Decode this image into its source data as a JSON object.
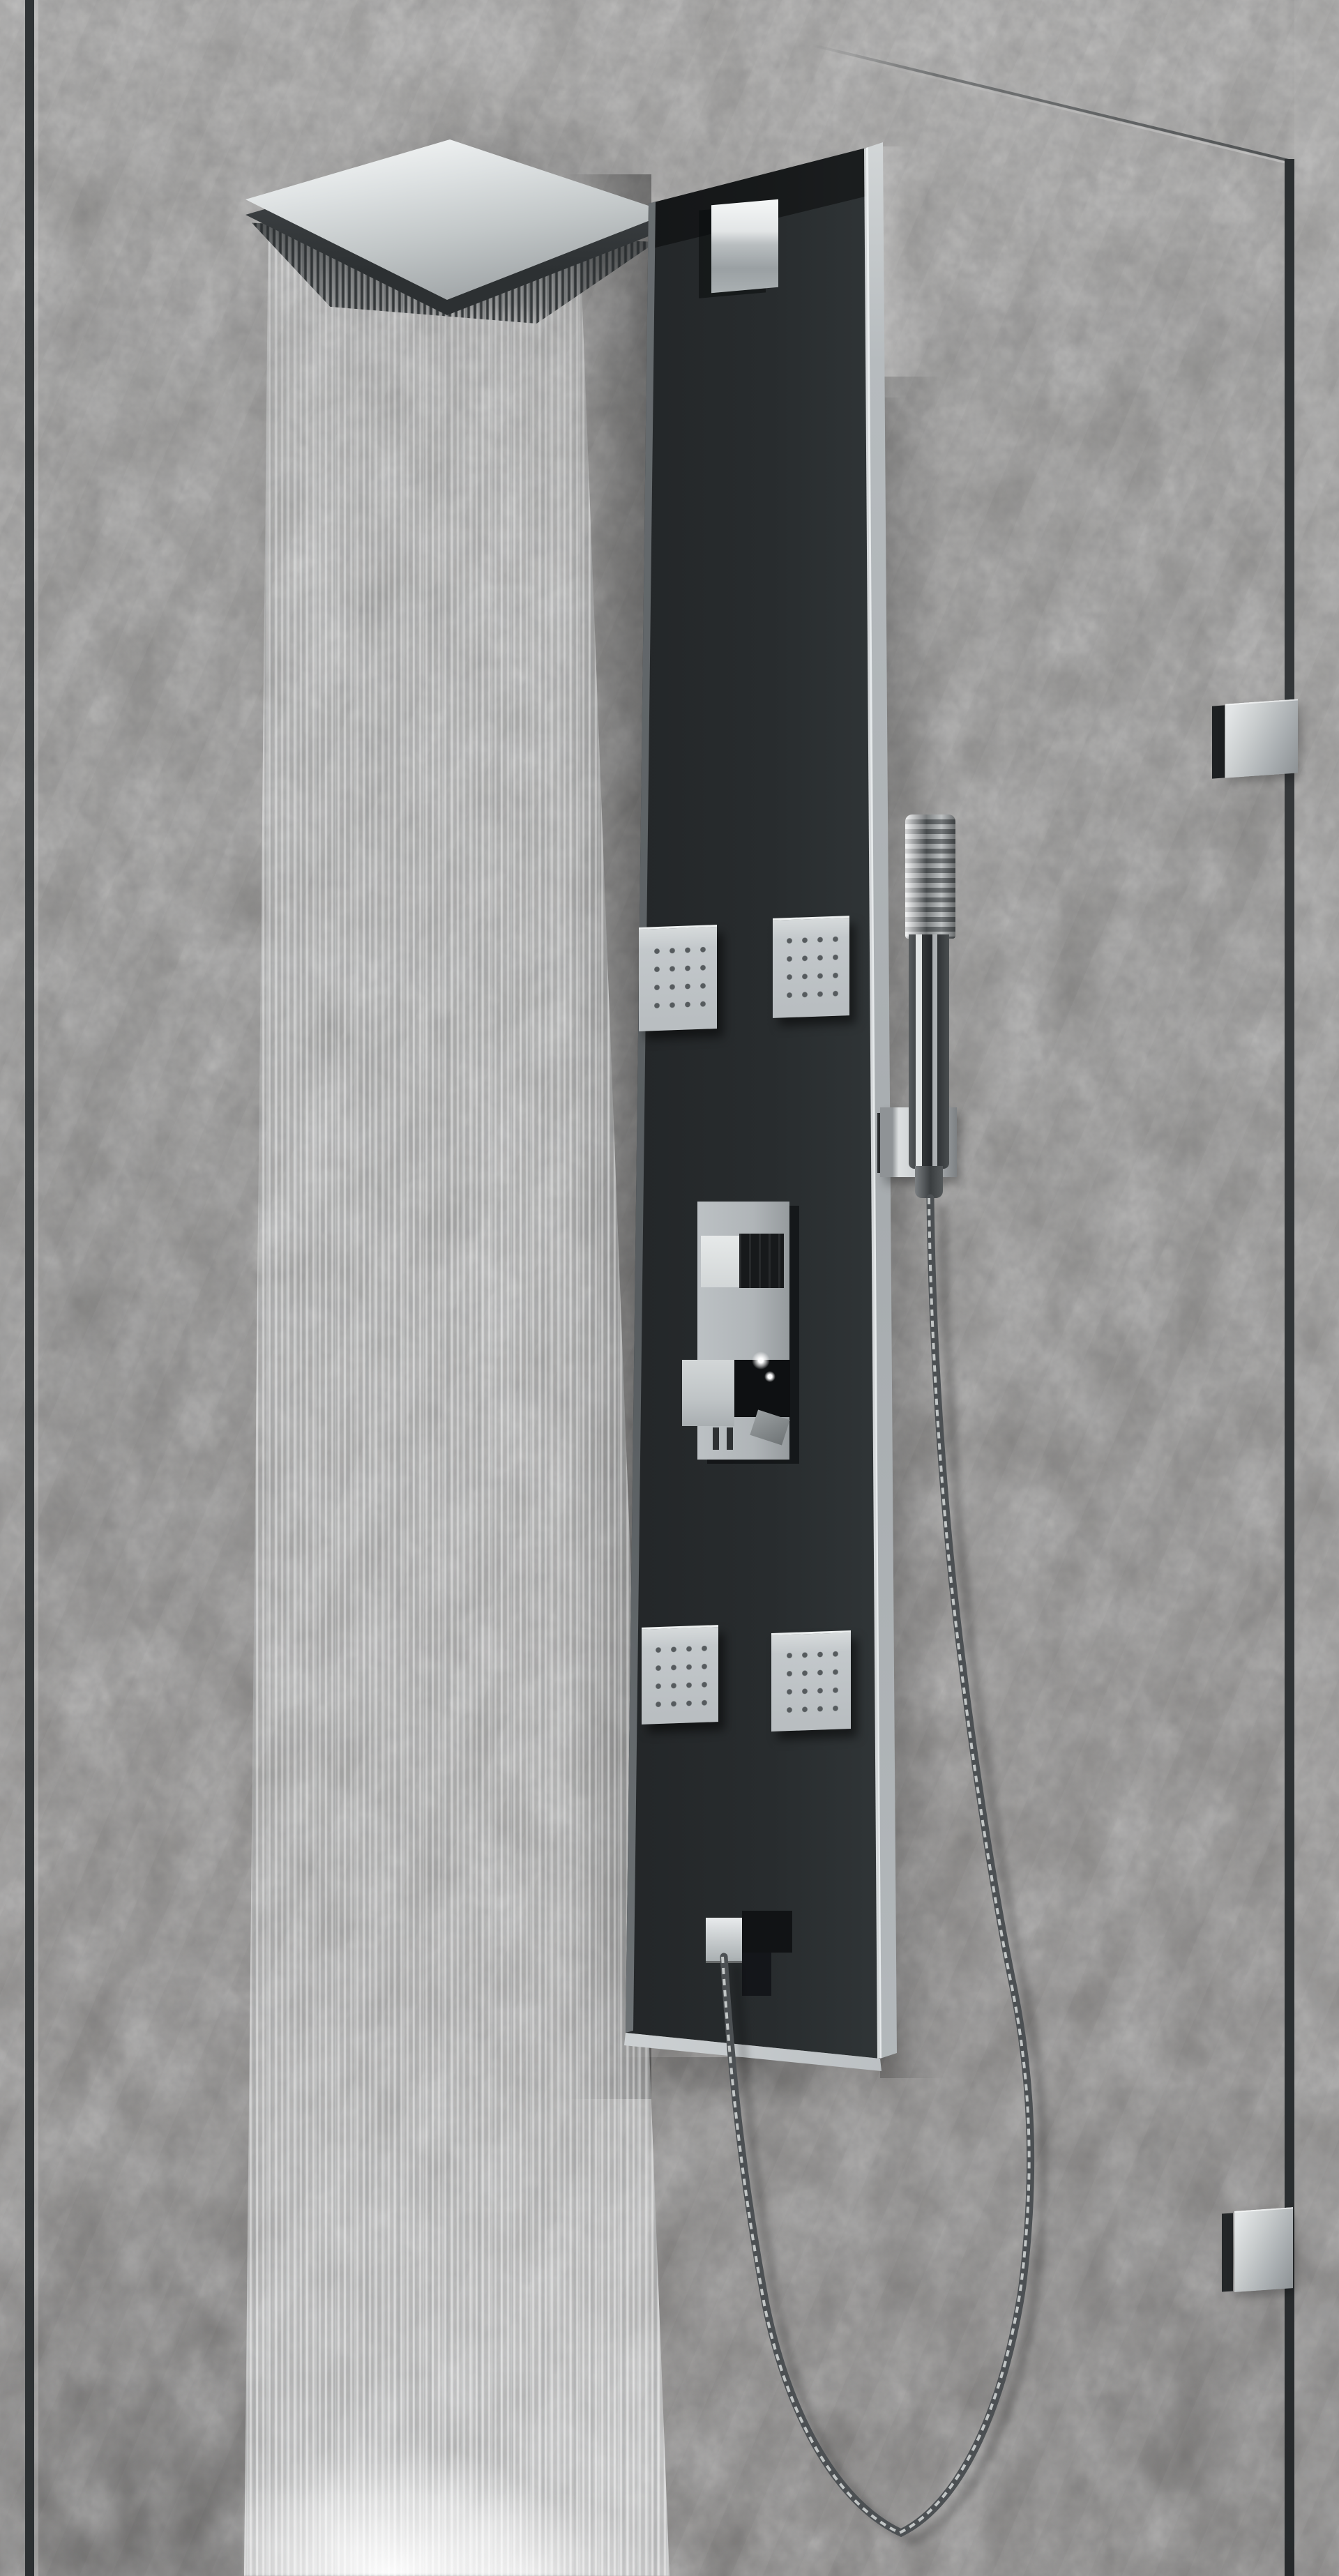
{
  "scene": {
    "description": "Product photo of a black wall-mounted shower panel column with chrome fixtures inside a glass walk-in shower on a grey concrete wall, rainfall head running with a falling water curtain",
    "parts": [
      "glass-wall-left",
      "glass-wall-right",
      "glass-hinges",
      "rain-shower-head",
      "water-curtain",
      "shower-panel-column",
      "wall-mount-bracket",
      "body-jets",
      "thermostatic-mixer",
      "hand-shower",
      "shower-hose",
      "water-spout",
      "splash"
    ]
  },
  "colors": {
    "wall-top": "#a09f9d",
    "wall-mid": "#8e8d8b",
    "wall-bottom": "#807e7c",
    "panel-black": "#26292b",
    "panel-frame-chrome": "#c9cdd0",
    "chrome-bright": "#eef1f1",
    "chrome-mid": "#b7bcbf",
    "chrome-dark": "#8f9497",
    "glass-edge": "#323638",
    "water-white": "#e8eaeb",
    "jet-face": "#c8cdd0",
    "jet-nozzle": "#565b5e",
    "hose-base": "#53575a",
    "hose-highlight": "#d7dadb",
    "shadow-deep": "#141617"
  },
  "counts": {
    "body_jets": 4,
    "glass_hinges": 2
  }
}
